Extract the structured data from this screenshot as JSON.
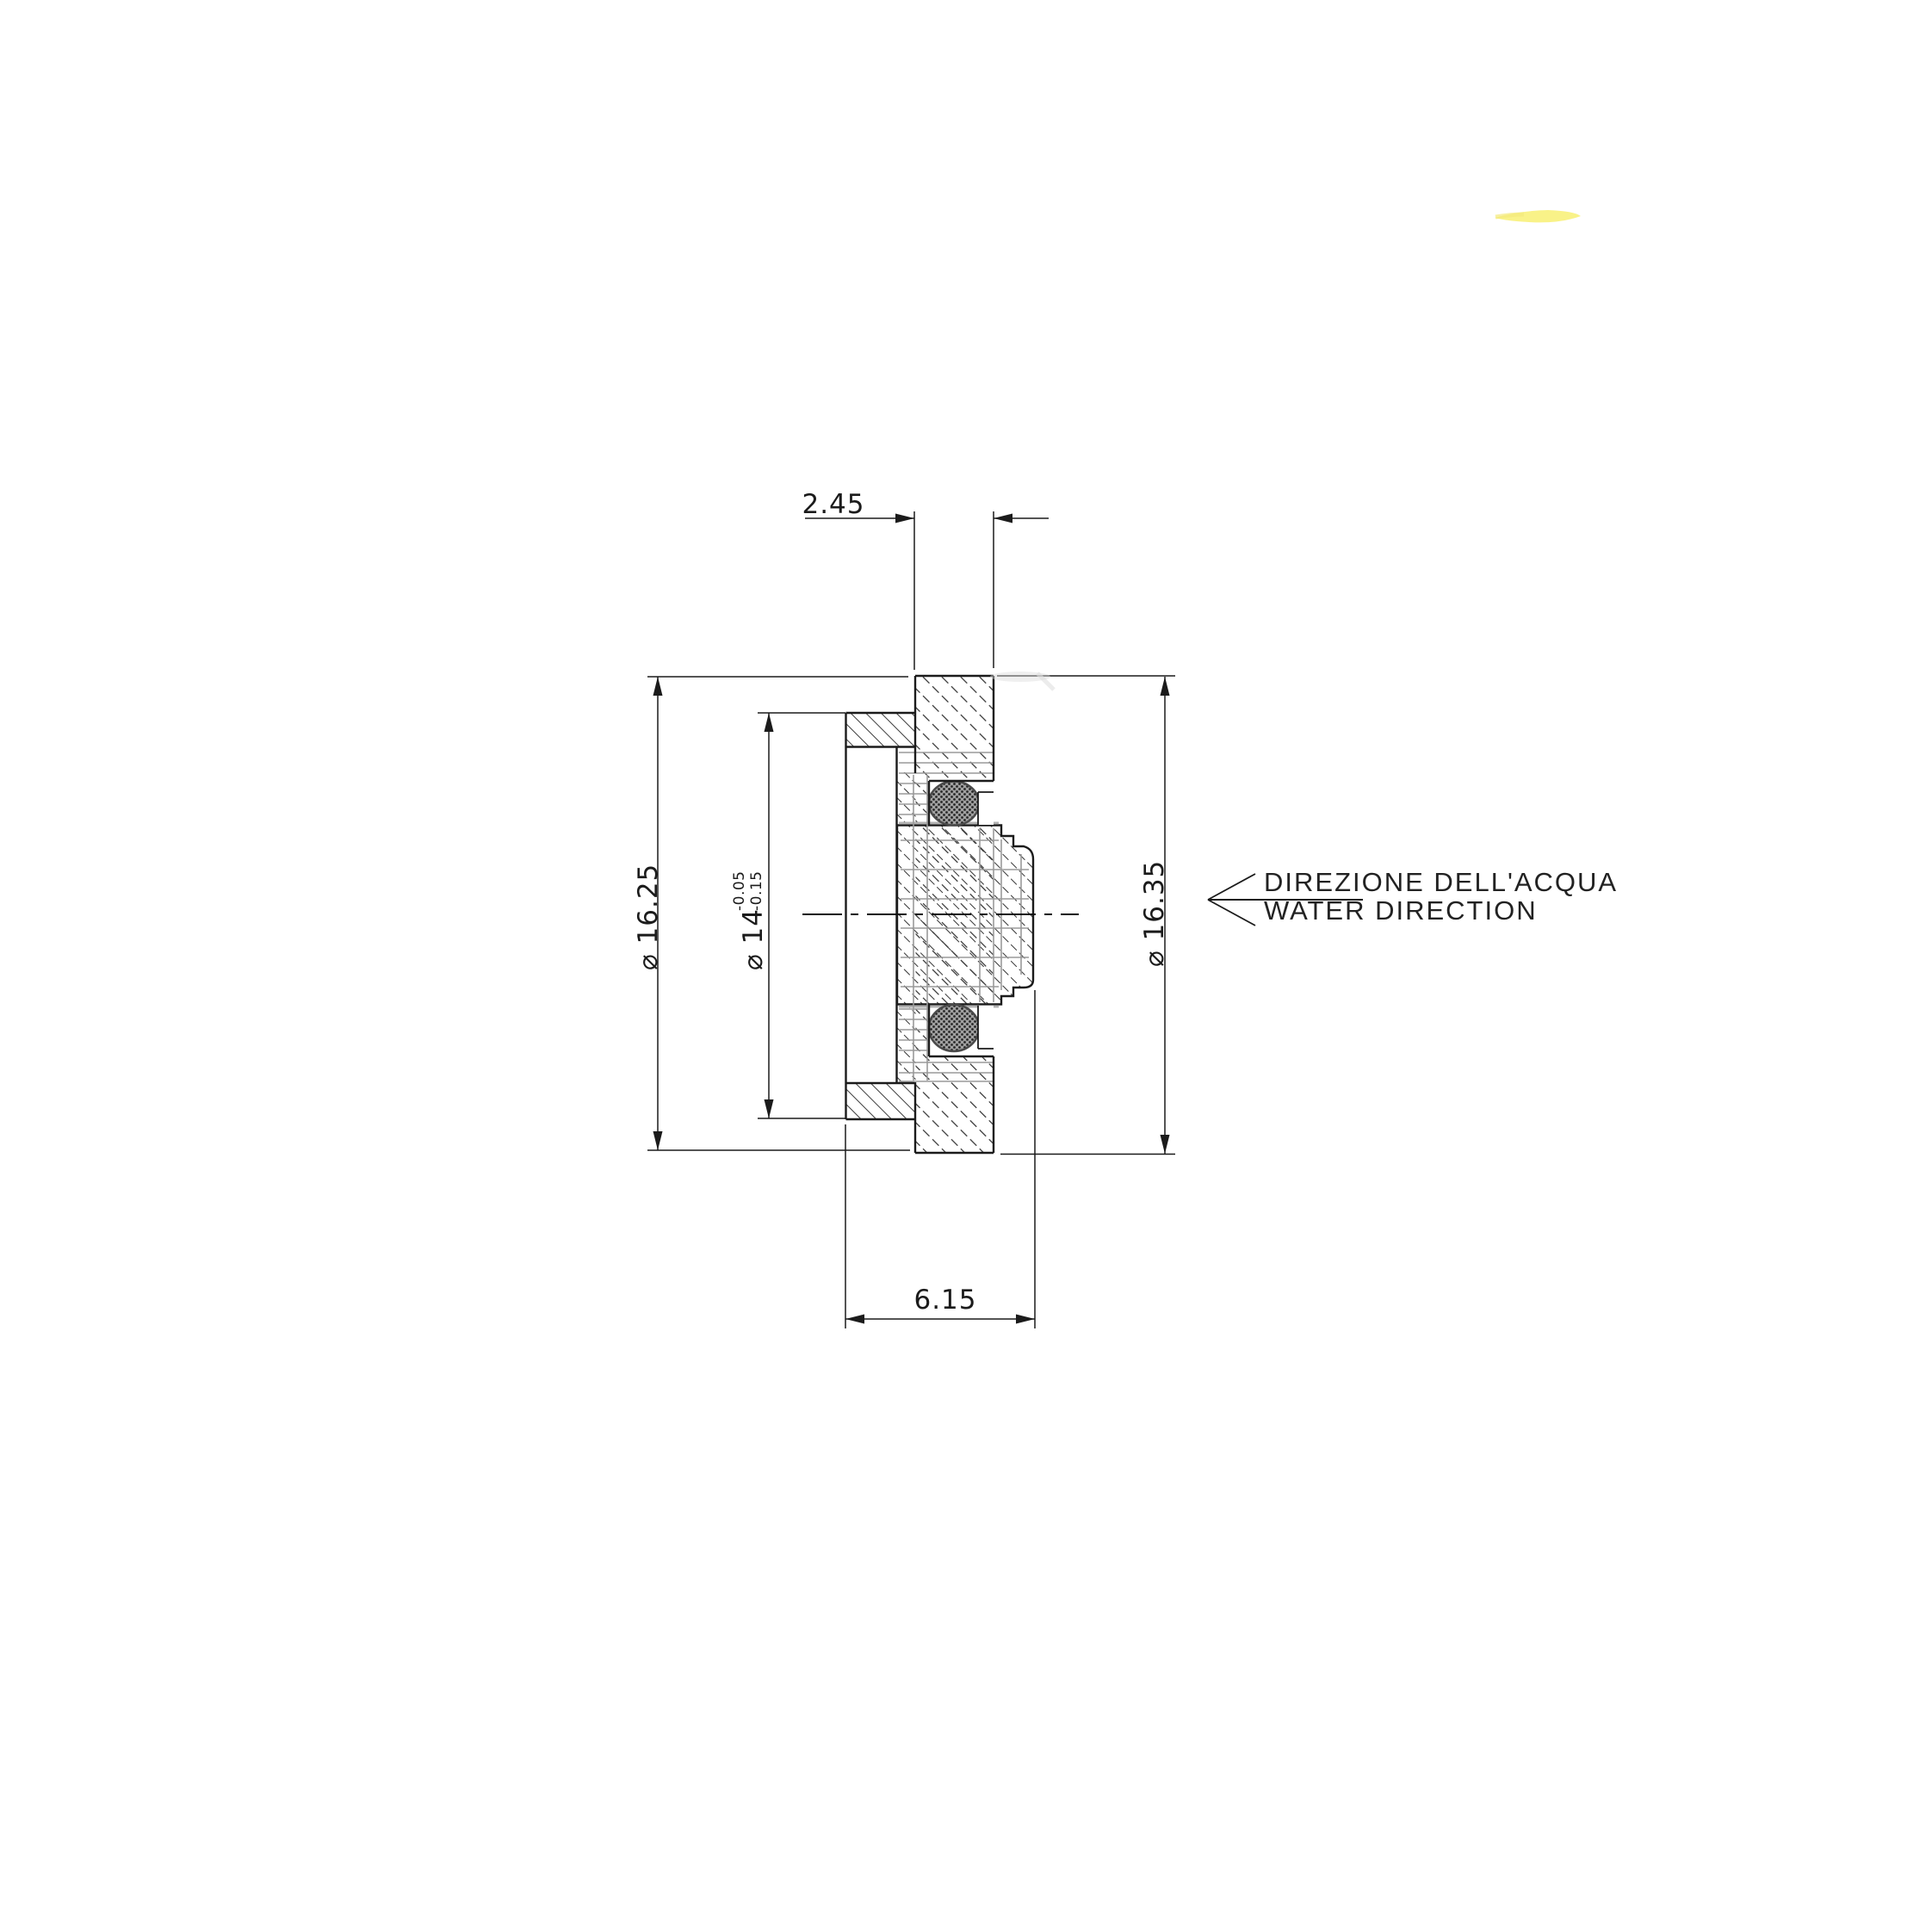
{
  "drawing": {
    "dim_top_width": {
      "value": "2.45"
    },
    "dim_bottom_width": {
      "value": "6.15"
    },
    "dim_outer_left": {
      "value": "⌀ 16.25"
    },
    "dim_bore": {
      "value": "⌀ 14",
      "tol_upper": "-0.05",
      "tol_lower": "-0.15"
    },
    "dim_outer_right": {
      "value": "⌀ 16.35"
    },
    "flow_note": {
      "line1": "DIREZIONE DELL'ACQUA",
      "line2": "WATER DIRECTION"
    },
    "colors": {
      "ink": "#1b1b1b",
      "ghost_line": "#9a9a9a",
      "highlighter": "#f7ef6a",
      "paper": "#ffffff"
    }
  }
}
